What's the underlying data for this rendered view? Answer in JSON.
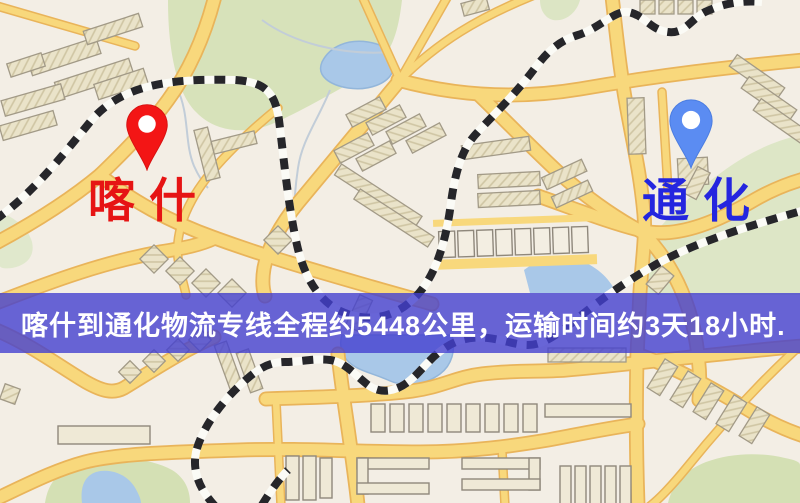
{
  "map": {
    "origin": {
      "label": "喀什",
      "label_color": "#e61414",
      "pin_color": "#f31515"
    },
    "destination": {
      "label": "通化",
      "label_color": "#2426df",
      "pin_color": "#5b8cf2"
    }
  },
  "banner": {
    "text": "喀什到通化物流专线全程约5448公里，运输时间约3天18小时.",
    "background_color": "#4340cf",
    "text_color": "#ffffff"
  },
  "map_colors": {
    "background": "#f3eee5",
    "road_fill": "#f8d87c",
    "road_casing": "#e9b45a",
    "water": "#a9c8e8",
    "park_green": "#d8e2ba",
    "building": "#eae3c9",
    "railway_dark": "#26262a"
  }
}
